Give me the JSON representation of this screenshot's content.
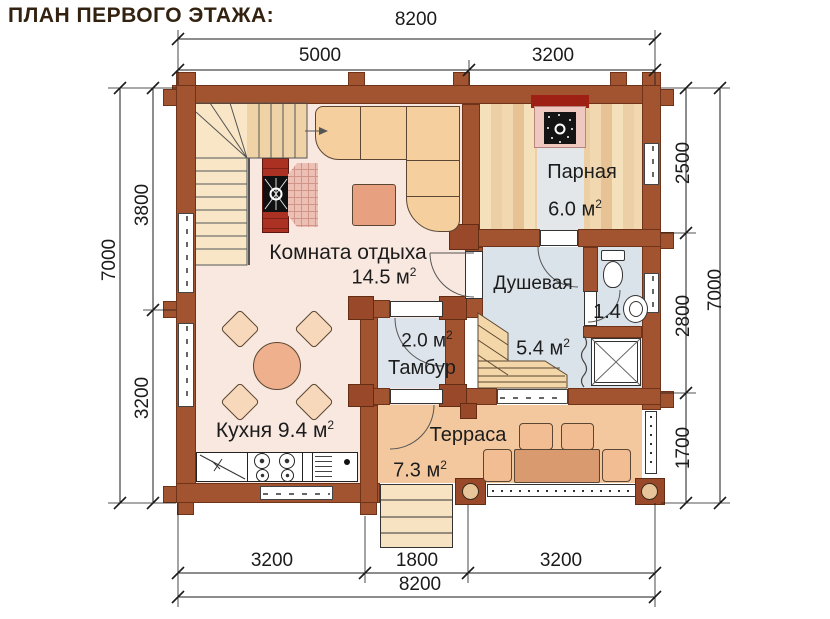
{
  "title": "ПЛАН ПЕРВОГО ЭТАЖА:",
  "rooms": {
    "rest": {
      "name": "Комната отдыха",
      "area": "14.5 м",
      "sup": "2"
    },
    "sauna": {
      "name": "Парная",
      "area": "6.0 м",
      "sup": "2"
    },
    "shower": {
      "name": "Душевая",
      "area": "5.4 м",
      "sup": "2"
    },
    "wc": {
      "area": "1.4"
    },
    "vestibule": {
      "name": "Тамбур",
      "area": "2.0 м",
      "sup": "2"
    },
    "kitchen": {
      "name": "Кухня 9.4 м",
      "sup": "2"
    },
    "terrace": {
      "name": "Терраса",
      "area": "7.3 м",
      "sup": "2"
    }
  },
  "dimensions": {
    "top": {
      "overall": "8200",
      "left": "5000",
      "right": "3200"
    },
    "bottom": {
      "left": "3200",
      "middle": "1800",
      "right": "3200",
      "overall": "8200"
    },
    "left": {
      "overall": "7000",
      "top": "3800",
      "bottom": "3200"
    },
    "right": {
      "top": "2500",
      "middle": "2800",
      "bottom": "1700",
      "overall": "7000"
    }
  },
  "colors": {
    "wall": "#a2532f",
    "floor_main": "#f9e8e0",
    "floor_wet": "#dbe3ea",
    "floor_terrace": "#f4c89e",
    "stove_brick": "#a62f22",
    "dimension_ink": "#1b1b1b"
  }
}
